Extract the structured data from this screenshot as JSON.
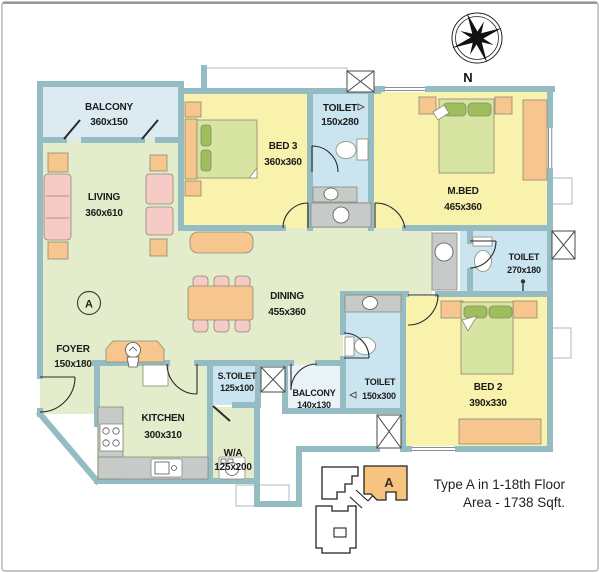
{
  "title": "Apartment floor plan Type A",
  "compass": {
    "north_label": "N"
  },
  "rooms": [
    {
      "key": "balcony_top",
      "name": "BALCONY",
      "dims": "360x150"
    },
    {
      "key": "living",
      "name": "LIVING",
      "dims": "360x610"
    },
    {
      "key": "bed3",
      "name": "BED 3",
      "dims": "360x360"
    },
    {
      "key": "toilet_top",
      "name": "TOILET",
      "dims": "150x280"
    },
    {
      "key": "mbed",
      "name": "M.BED",
      "dims": "465x360"
    },
    {
      "key": "toilet_right",
      "name": "TOILET",
      "dims": "270x180"
    },
    {
      "key": "dining",
      "name": "DINING",
      "dims": "455x360"
    },
    {
      "key": "foyer",
      "name": "FOYER",
      "dims": "150x180"
    },
    {
      "key": "kitchen",
      "name": "KITCHEN",
      "dims": "300x310"
    },
    {
      "key": "s_toilet",
      "name": "S.TOILET",
      "dims": "125x100"
    },
    {
      "key": "wa",
      "name": "W/A",
      "dims": "125x200"
    },
    {
      "key": "balcony_bottom",
      "name": "BALCONY",
      "dims": "140x130"
    },
    {
      "key": "toilet_bottom",
      "name": "TOILET",
      "dims": "150x300"
    },
    {
      "key": "bed2",
      "name": "BED 2",
      "dims": "390x330"
    }
  ],
  "section_marker": "A",
  "keyplan": {
    "unit_label": "A"
  },
  "caption": {
    "line1": "Type A in 1-18th Floor",
    "line2": "Area - 1738 Sqft."
  },
  "colors": {
    "wall": "#96BCC3",
    "room_green": "#E3ECCB",
    "room_yellow": "#F8F2AC",
    "room_blue": "#CBE5F0",
    "balcony_blue": "#DCEAF2",
    "furniture_orange": "#F7C68E",
    "furniture_pink": "#F6CBC6",
    "mattress_green": "#D8E5A2",
    "pillow_green": "#9DBE5A",
    "counter_gray": "#C6CBCA",
    "keyplan_orange": "#F7C480"
  }
}
